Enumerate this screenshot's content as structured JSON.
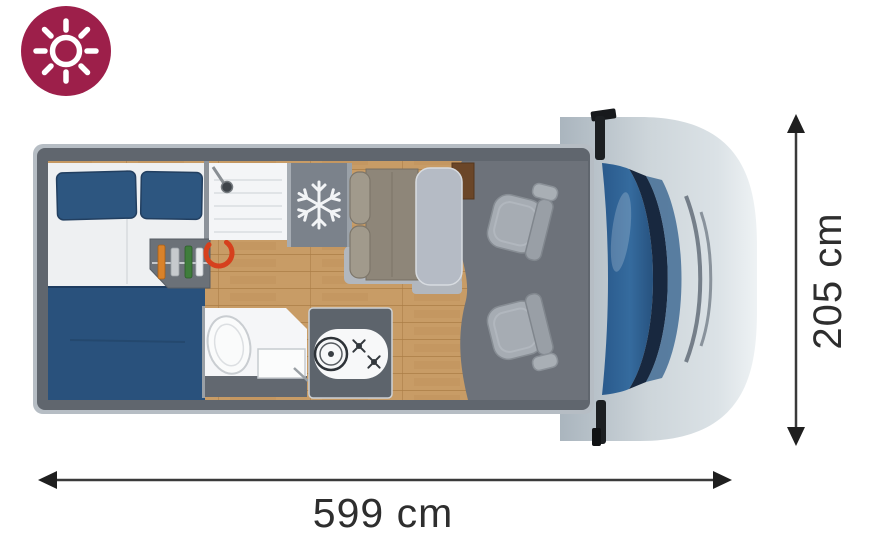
{
  "badge": {
    "icon": "sun-icon",
    "bg_color": "#9d1f4a",
    "icon_color": "#ffffff"
  },
  "floorplan": {
    "view": "campervan top-down floor plan",
    "length_label": "599 cm",
    "width_label": "205 cm",
    "zones": [
      "rear-double-bed",
      "wardrobe-shelf",
      "shower",
      "fridge-freezer",
      "dinette-bench",
      "dinette-table",
      "bathroom-toilet",
      "bathroom-sink",
      "kitchen-hob-and-sink",
      "swivel-cab-seats",
      "driver-cab-front"
    ],
    "colors": {
      "badge": "#9d1f4a",
      "bed_textile": "#2d5680",
      "wood_floor": "#c89c66",
      "wall_grey": "#60666e",
      "hood_blue": "#2e639a",
      "accent_ring": "#d6401d",
      "dimension_text": "#2e2e2e"
    }
  }
}
